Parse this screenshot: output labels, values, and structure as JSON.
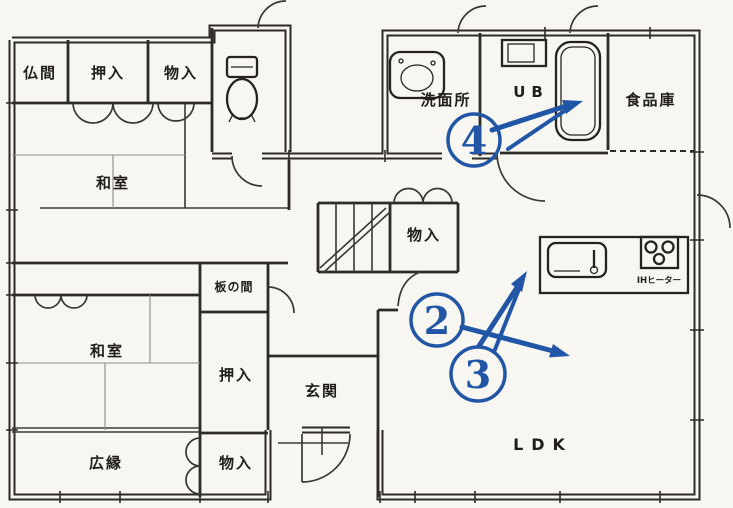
{
  "colors": {
    "annotation_blue": "#2056a5",
    "wall_ink": "#2e2b27",
    "paper": "#f8f6f1"
  },
  "rooms": {
    "butsuma": "仏間",
    "oshiire_top": "押入",
    "monoire_top": "物入",
    "washitsu_top": "和室",
    "senmenjo": "洗面所",
    "unit_bath": "UB",
    "pantry": "食品庫",
    "monoire_mid": "物入",
    "itanoma": "板の間",
    "washitsu_btm": "和室",
    "oshiire_btm": "押入",
    "genkan": "玄関",
    "hiroen": "広縁",
    "monoire_btm": "物入",
    "ldk": "LDK",
    "ih_heater": "IHヒーター"
  },
  "annotations": [
    {
      "number": "2"
    },
    {
      "number": "3"
    },
    {
      "number": "4"
    }
  ]
}
